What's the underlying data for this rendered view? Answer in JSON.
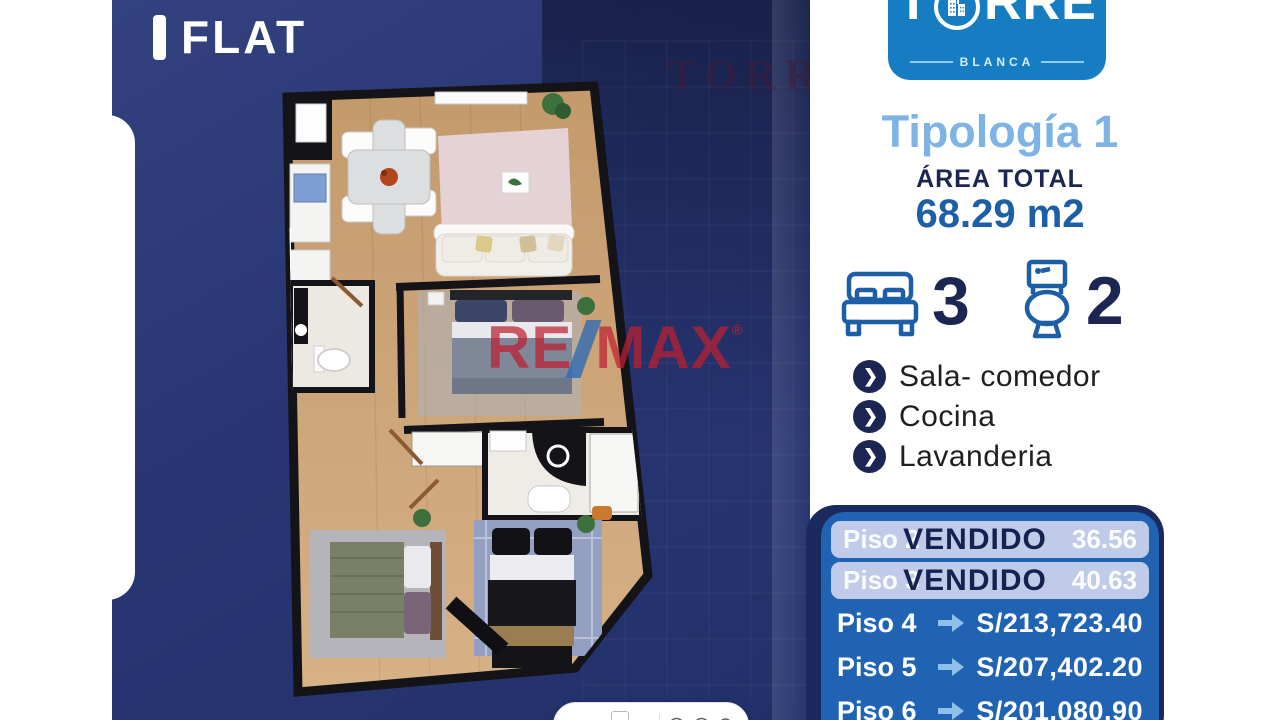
{
  "header": {
    "flat_label": "FLAT"
  },
  "logo": {
    "name_t": "T",
    "name_rre": "RRE",
    "subtitle": "BLANCA"
  },
  "typology": {
    "title": "Tipología 1",
    "area_label": "ÁREA TOTAL",
    "area_value": "68.29 m2"
  },
  "stats": {
    "bedrooms": "3",
    "bathrooms": "2"
  },
  "features": {
    "items": [
      "Sala- comedor",
      "Cocina",
      "Lavanderia"
    ],
    "chevron": "❯"
  },
  "prices": {
    "sold": [
      {
        "floor": "Piso 2",
        "status": "VENDIDO",
        "tail": "36.56"
      },
      {
        "floor": "Piso 3",
        "status": "VENDIDO",
        "tail": "40.63"
      }
    ],
    "available": [
      {
        "floor": "Piso 4",
        "price": "S/213,723.40"
      },
      {
        "floor": "Piso 5",
        "price": "S/207,402.20"
      },
      {
        "floor": "Piso 6",
        "price": "S/201,080.90"
      }
    ]
  },
  "watermarks": {
    "torre": "TORRE",
    "remax_re": "RE",
    "remax_max": "MAX",
    "registered": "®"
  },
  "viewer_toolbar": {
    "page": "4",
    "page_total": "/ 6"
  },
  "colors": {
    "panel_navy": "#2a3775",
    "logo_blue": "#177dc2",
    "light_blue": "#7db4e4",
    "accent_blue": "#1d5fa6",
    "navy_text": "#1b2653",
    "price_box_blue": "#1f63b2",
    "sold_pill": "#bfcbe8",
    "remax_red": "#be2030"
  }
}
